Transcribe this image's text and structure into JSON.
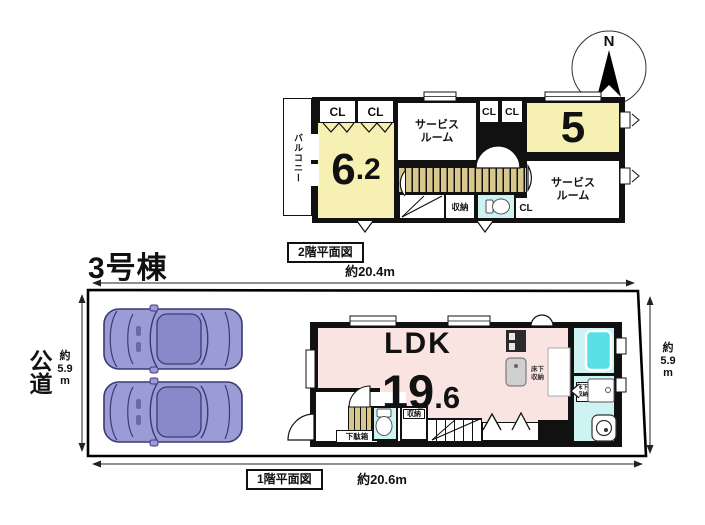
{
  "building": {
    "label": "3号棟"
  },
  "compass": {
    "north": "N"
  },
  "floor2": {
    "caption": "2階平面図",
    "width_dim": "約20.4m",
    "balcony": "バルコニー",
    "closet": "CL",
    "service_room": "サービスルーム",
    "room5": "5",
    "room62_int": "6",
    "room62_dec": ".2",
    "storage": "収納"
  },
  "floor1": {
    "caption": "1階平面図",
    "width_dim": "約20.6m",
    "ldk": "LDK",
    "ldk_int": "19",
    "ldk_dec": ".6",
    "shoe_cabinet": "下駄箱",
    "storage": "収納",
    "underfloor_storage": "床下収納"
  },
  "site": {
    "road": "公道",
    "left_dim": {
      "approx": "約",
      "value": "5.9",
      "unit": "m"
    },
    "right_dim": {
      "approx": "約",
      "value": "5.9",
      "unit": "m"
    }
  },
  "colors": {
    "room_yellow": "#F6F1B2",
    "room_pink": "#FAE4E2",
    "wet_cyan": "#CDF3F3",
    "bathtub_cyan": "#59DFE7",
    "stair_tan": "#D8C78C",
    "car_body": "#9B9CD6",
    "wall": "#111111"
  }
}
